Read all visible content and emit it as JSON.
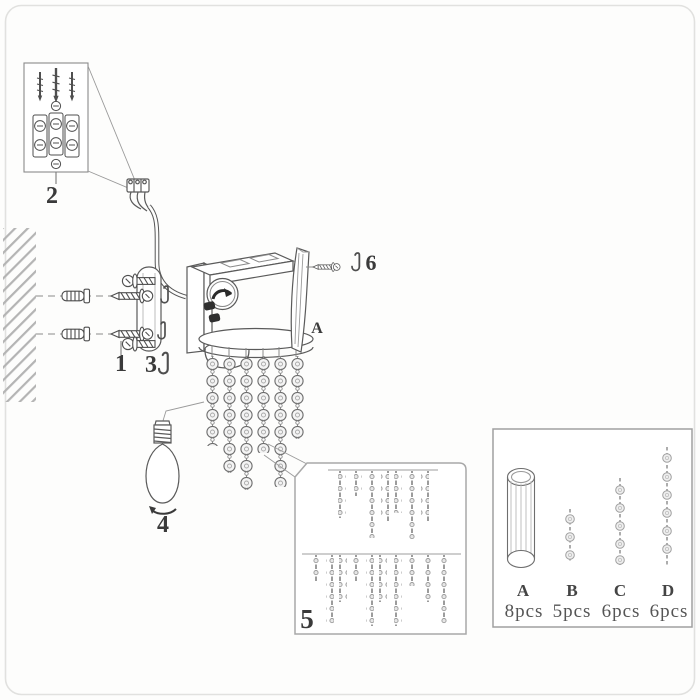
{
  "diagram_title": "wall lamp assembly instructions",
  "colors": {
    "line": "#4f4f4f",
    "label": "#3a3a3a",
    "hatch": "#b4b4b4",
    "box_stroke": "#a8a8a8",
    "bead_fill": "#efefef"
  },
  "callouts": {
    "c1": {
      "label": "1"
    },
    "c2": {
      "label": "2"
    },
    "c3": {
      "label": "3"
    },
    "c4": {
      "label": "4"
    },
    "c5": {
      "label": "5"
    },
    "c6": {
      "label": "6"
    },
    "panel": {
      "label": "A"
    }
  },
  "legend": {
    "items": [
      {
        "label": "A",
        "count": "8pcs"
      },
      {
        "label": "B",
        "count": "5pcs"
      },
      {
        "label": "C",
        "count": "6pcs"
      },
      {
        "label": "D",
        "count": "6pcs"
      }
    ]
  }
}
